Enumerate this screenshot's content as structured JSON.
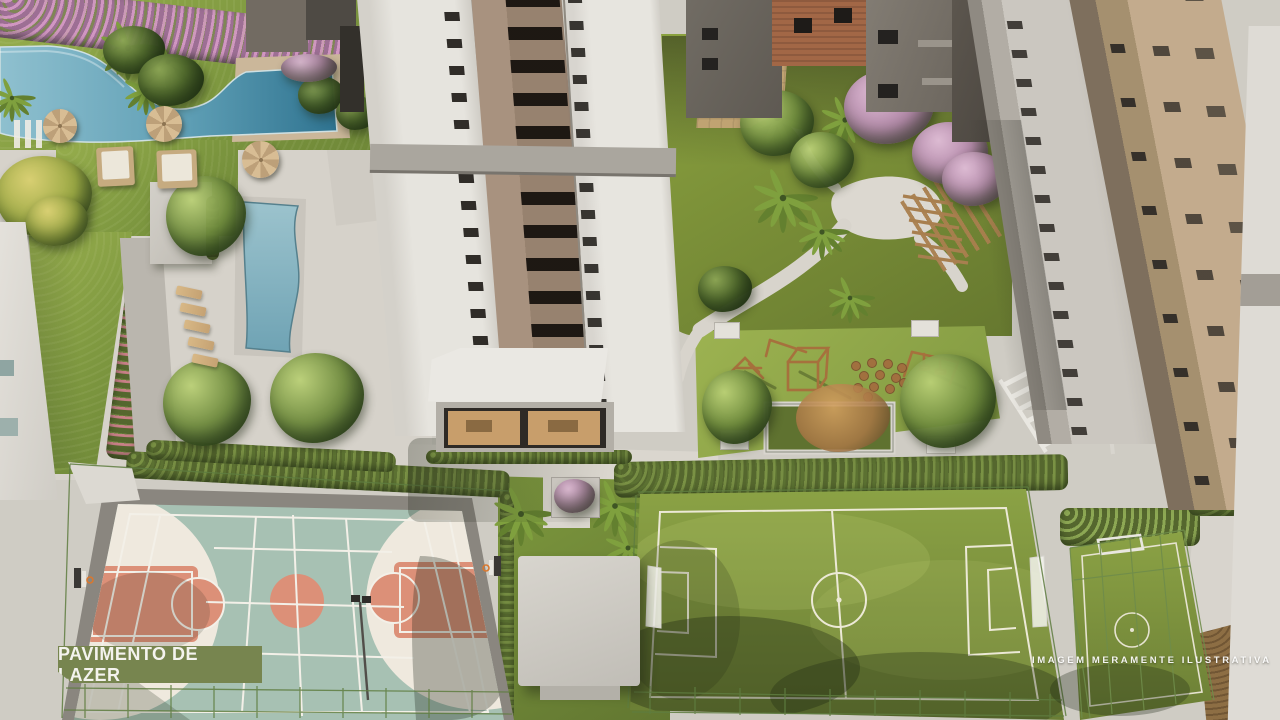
{
  "image_type": "aerial-architectural-render",
  "labels": {
    "banner": "PAVIMENTO DE LAZER",
    "disclaimer": "IMAGEM MERAMENTE ILUSTRATIVA"
  },
  "palette": {
    "banner_bg": "#77854f",
    "banner_text": "#f4f3ee",
    "lawn_green": "#8da746",
    "pool_water_light": "#9cc3cd",
    "pool_water_dark": "#2f7390",
    "deck_tan": "#cbb79a",
    "court_teal": "#a7c1b3",
    "court_salmon": "#dc9078",
    "court_cream": "#efe9de",
    "soccer_green": "#839a42",
    "facade_white": "#e3e0da",
    "facade_tan": "#c3ab8d",
    "wood_brown": "#a6713d"
  },
  "scene_features": [
    "lagoon-pool-with-palm-island",
    "lap-pool",
    "pool-deck-umbrellas",
    "daybeds",
    "chaise-lounges",
    "residential-tower",
    "amenity-lounge",
    "landscaped-garden",
    "pergola",
    "playground",
    "stepping-logs",
    "multisport-court",
    "basketball-hoops",
    "soccer-field",
    "mini-soccer-field",
    "kiosk-roof",
    "neighbor-towers"
  ]
}
